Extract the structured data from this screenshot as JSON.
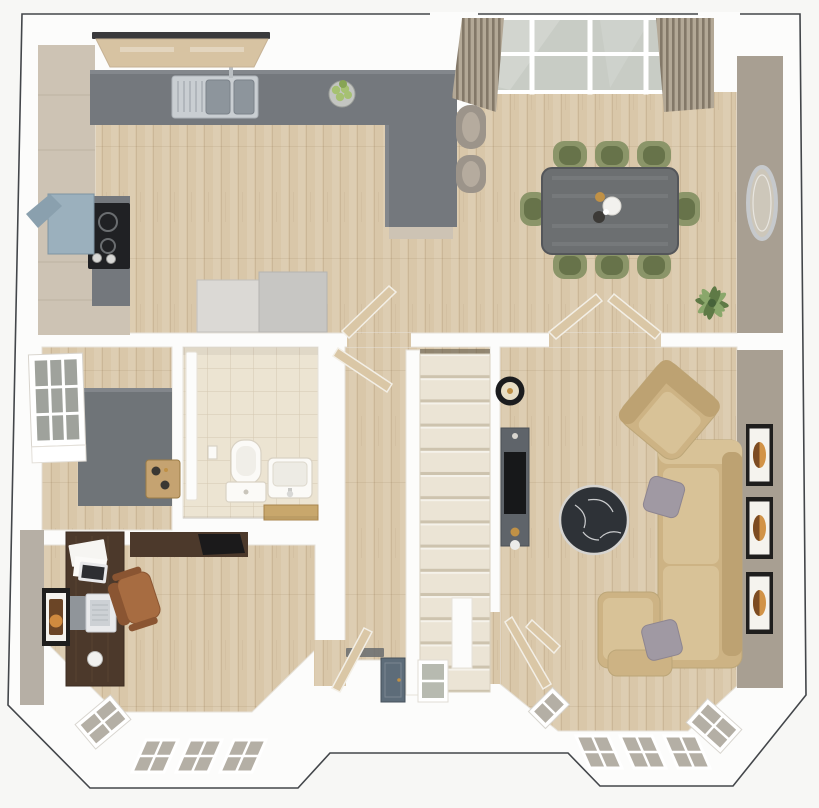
{
  "scene": {
    "type": "3d floor plan render, top-down dollhouse view",
    "floor_shown": "ground floor with two front bay windows and rear glazed doors",
    "no_text_labels": true,
    "rooms": [
      {
        "name": "kitchen breakfast area",
        "furniture": [
          "L-shaped slate worktop",
          "breakfast peninsula",
          "stainless double sink with tap",
          "4-ring hob",
          "cooker hood",
          "tall beige cabinets",
          "two appliance units",
          "fruit bowl with apples",
          "2 bar stools",
          "window over sink"
        ]
      },
      {
        "name": "dining area",
        "furniture": [
          "rectangular grey-wood table",
          "8 sage-green chairs",
          "glazed garden doors",
          "two striped curtain panels",
          "oval wall mirror",
          "potted plant"
        ]
      },
      {
        "name": "living room",
        "furniture": [
          "corner sofa with chaise",
          "ottoman",
          "2 grey cushions",
          "tan armchair",
          "round black marble coffee table",
          "media console with TV",
          "black floor lamp",
          "3 framed prints on wall",
          "bay window"
        ]
      },
      {
        "name": "study",
        "furniture": [
          "walnut desk",
          "walnut wall shelf with bag",
          "brown leather office chair",
          "laptop",
          "tablet and papers",
          "decor sphere",
          "framed print",
          "bay window"
        ]
      },
      {
        "name": "wc",
        "furniture": [
          "toilet with cistern",
          "wash basin",
          "toilet-roll holder",
          "shelf with book",
          "tiled floor",
          "white door"
        ]
      },
      {
        "name": "store utility",
        "furniture": [
          "slate worktop",
          "wooden tray with bottles",
          "side window"
        ]
      },
      {
        "name": "hallway",
        "furniture": [
          "staircase",
          "front door",
          "door sidelight window",
          "doormat",
          "vestibule wall"
        ]
      }
    ],
    "inventory": {
      "dining_chairs": 8,
      "bar_stools": 2,
      "living_room_wall_frames": 3,
      "study_wall_frames": 1,
      "open_door_leaves": 7,
      "stair_treads_visible": 14,
      "bay_windows": 2
    }
  },
  "colors": {
    "pageBg": "#f7f7f5",
    "outline": "#43464a",
    "wallWhite": "#fcfcfb",
    "wallTaupe": "#a89f92",
    "wallGreige": "#b6afa5",
    "woodFloor": "#d9c7a9",
    "tileFloor": "#ece4d2",
    "counterSlate": "#74787d",
    "counterLight": "#83878c",
    "cabinetBeige": "#cdc3b4",
    "cabinetLine": "#b4a997",
    "stainless": "#c9ced2",
    "sinkBowl": "#8d959c",
    "hobBlack": "#202124",
    "extractorBlue": "#9bb0bd",
    "applianceLight": "#dbd9d5",
    "applianceDark": "#c7c6c3",
    "tableWood": "#6c6f71",
    "tableEdge": "#54565a",
    "chairGreenOuter": "#8b9569",
    "chairGreenSeat": "#67734a",
    "stoolOuter": "#9c948a",
    "stoolSeat": "#b5ab9e",
    "curtainBase": "#b3a896",
    "curtainStripe": "#837868",
    "glassDoor": "#c8ccc5",
    "glassBay": "#b4afa5",
    "sillBeige": "#d7c3a2",
    "lintelDark": "#3a3a3c",
    "mirrorFrame": "#c6c9cc",
    "mirrorGlass": "#cdc7ba",
    "plantDark": "#5f7a46",
    "plantLight": "#8aa76b",
    "appleGreen": "#a6c172",
    "bowlGray": "#c3c5c1",
    "stairTread": "#ebe4d5",
    "treadLine": "#cdc3ae",
    "doorLeafTan": "#dac7a6",
    "doorLeafEdge": "#f3efe6",
    "frontDoorBlue": "#5d6c79",
    "doormatGray": "#686c6f",
    "toiletWhite": "#fbfaf7",
    "fixtureLine": "#d9d2c4",
    "bookTan": "#c8a76c",
    "trayWood": "#c5a371",
    "benchSlate": "#6f7478",
    "deskWalnut": "#4c392b",
    "deskGrain": "#5d4634",
    "leatherChair": "#a76c41",
    "leatherDark": "#8a5532",
    "laptopSilver": "#e9eaec",
    "screenDark": "#2d2e32",
    "frameBlack": "#1f1e1d",
    "matWhite": "#f5f3ee",
    "artAmber": "#d29347",
    "artBrown": "#7c4b22",
    "sofaTan": "#cdb384",
    "sofaLight": "#d8c297",
    "sofaDark": "#bda272",
    "pillowGray": "#a099a3",
    "marbleBlack": "#2e3237",
    "marbleRim": "#d6d4d0",
    "veinWhite": "#e8e9ea",
    "consoleSlate": "#5f646a",
    "tvBlack": "#17181a",
    "goldAccent": "#c09146",
    "lampBlack": "#1b1c1e",
    "lampShade": "#e8dec5",
    "threshold": "#d9d4cb"
  }
}
